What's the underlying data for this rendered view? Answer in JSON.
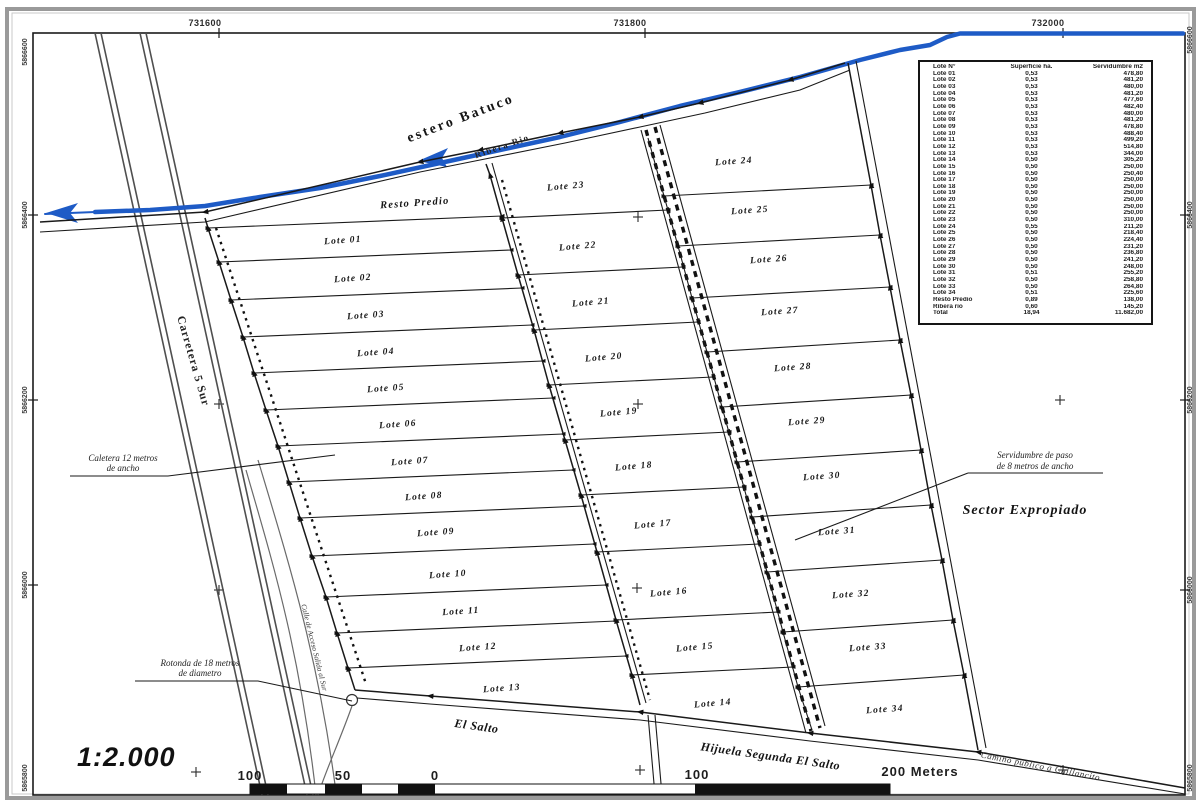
{
  "map": {
    "scale_text": "1:2.000",
    "grid": {
      "top": [
        "731600",
        "731800",
        "732000"
      ],
      "left": [
        "5866600",
        "5866400",
        "5866200",
        "5866000",
        "5865800"
      ],
      "right": [
        "5866600",
        "5866400",
        "5866200",
        "5866000",
        "5865800"
      ]
    },
    "labels": {
      "estero": "estero Batuco",
      "ribera": "Ribera Rio",
      "resto": "Resto Predio",
      "carretera": "Carretera 5 Sur",
      "calle": "Calle de Acceso Salida al Sur",
      "caletera1": "Caletera 12 metros",
      "caletera2": "de ancho",
      "rotonda1": "Rotonda de 18 metros",
      "rotonda2": "de diametro",
      "serv1": "Servidumbre de paso",
      "serv2": "de 8 metros de ancho",
      "sector": "Sector Expropiado",
      "salto": "El Salto",
      "hijuela": "Hijuela Segunda El Salto",
      "camino": "Camino publico a Chillancito"
    },
    "scalebar": {
      "labels": [
        "100",
        "50",
        "0",
        "100",
        "200 Meters"
      ]
    },
    "lot_labels": [
      "Lote 01",
      "Lote 02",
      "Lote 03",
      "Lote 04",
      "Lote 05",
      "Lote 06",
      "Lote 07",
      "Lote 08",
      "Lote 09",
      "Lote 10",
      "Lote 11",
      "Lote 12",
      "Lote 13",
      "Lote 14",
      "Lote 15",
      "Lote 16",
      "Lote 17",
      "Lote 18",
      "Lote 19",
      "Lote 20",
      "Lote 21",
      "Lote 22",
      "Lote 23",
      "Lote 24",
      "Lote 25",
      "Lote 26",
      "Lote 27",
      "Lote 28",
      "Lote 29",
      "Lote 30",
      "Lote 31",
      "Lote 32",
      "Lote 33",
      "Lote 34"
    ]
  },
  "table": {
    "headers": [
      "Lote N°",
      "Superficie ha.",
      "Servidumbre m2"
    ],
    "rows": [
      [
        "Lote 01",
        "0,53",
        "478,80"
      ],
      [
        "Lote 02",
        "0,53",
        "481,20"
      ],
      [
        "Lote 03",
        "0,53",
        "480,00"
      ],
      [
        "Lote 04",
        "0,53",
        "481,20"
      ],
      [
        "Lote 05",
        "0,53",
        "477,60"
      ],
      [
        "Lote 06",
        "0,53",
        "482,40"
      ],
      [
        "Lote 07",
        "0,53",
        "480,00"
      ],
      [
        "Lote 08",
        "0,53",
        "481,20"
      ],
      [
        "Lote 09",
        "0,53",
        "478,80"
      ],
      [
        "Lote 10",
        "0,53",
        "488,40"
      ],
      [
        "Lote 11",
        "0,53",
        "499,20"
      ],
      [
        "Lote 12",
        "0,53",
        "514,80"
      ],
      [
        "Lote 13",
        "0,53",
        "344,00"
      ],
      [
        "Lote 14",
        "0,50",
        "305,20"
      ],
      [
        "Lote 15",
        "0,50",
        "250,00"
      ],
      [
        "Lote 16",
        "0,50",
        "250,40"
      ],
      [
        "Lote 17",
        "0,50",
        "250,00"
      ],
      [
        "Lote 18",
        "0,50",
        "250,00"
      ],
      [
        "Lote 19",
        "0,50",
        "250,00"
      ],
      [
        "Lote 20",
        "0,50",
        "250,00"
      ],
      [
        "Lote 21",
        "0,50",
        "250,00"
      ],
      [
        "Lote 22",
        "0,50",
        "250,00"
      ],
      [
        "Lote 23",
        "0,50",
        "310,00"
      ],
      [
        "Lote 24",
        "0,55",
        "211,20"
      ],
      [
        "Lote 25",
        "0,50",
        "218,40"
      ],
      [
        "Lote 26",
        "0,50",
        "224,40"
      ],
      [
        "Lote 27",
        "0,50",
        "231,20"
      ],
      [
        "Lote 28",
        "0,50",
        "236,80"
      ],
      [
        "Lote 29",
        "0,50",
        "241,20"
      ],
      [
        "Lote 30",
        "0,50",
        "248,00"
      ],
      [
        "Lote 31",
        "0,51",
        "255,20"
      ],
      [
        "Lote 32",
        "0,50",
        "258,80"
      ],
      [
        "Lote 33",
        "0,50",
        "264,80"
      ],
      [
        "Lote 34",
        "0,51",
        "225,60"
      ],
      [
        "Resto Predio",
        "0,89",
        "138,00"
      ],
      [
        "Ribera rio",
        "0,60",
        "145,20"
      ],
      [
        "Total",
        "18,94",
        "11.682,00"
      ]
    ]
  }
}
